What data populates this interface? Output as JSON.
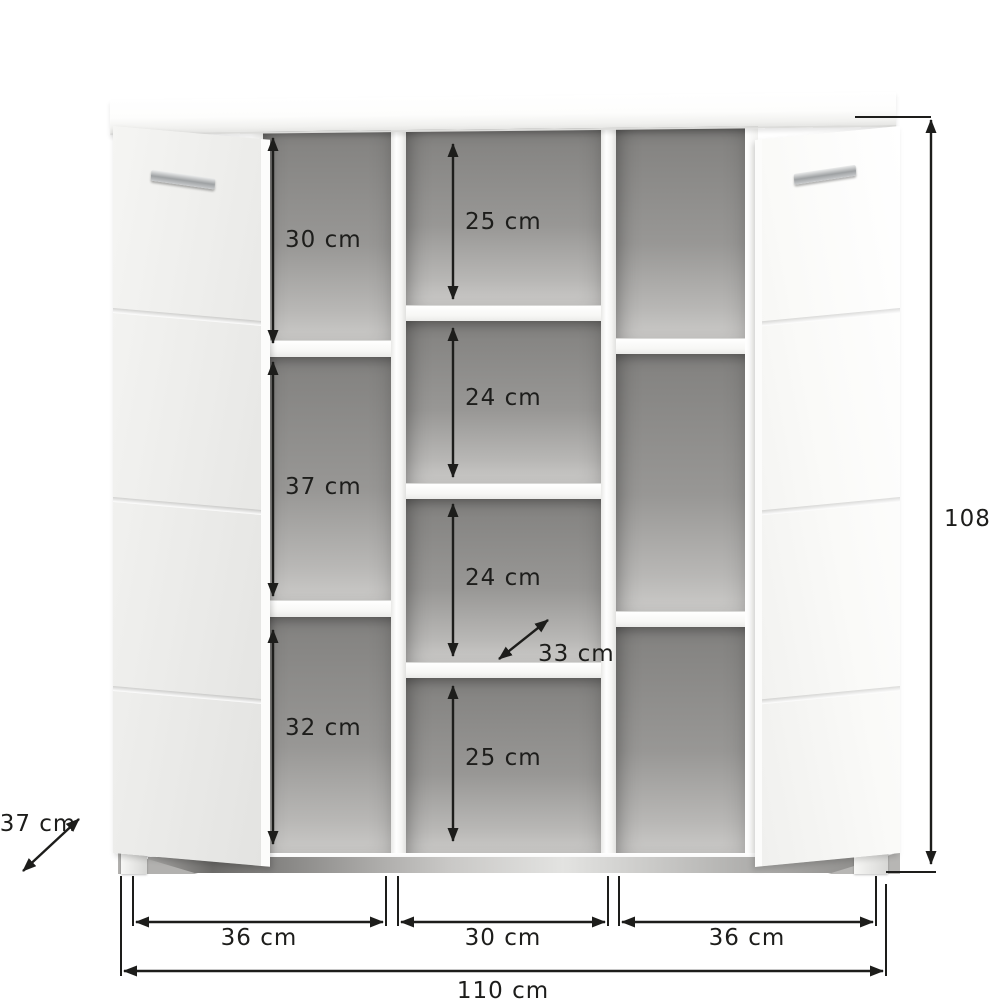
{
  "diagram": {
    "type": "furniture-dimension-diagram",
    "subject": "shoe cabinet with two open doors and open shelf compartments",
    "colors": {
      "background": "#ffffff",
      "dimension_ink": "#1d1d1b",
      "cabinet_white": "#fbfbfa",
      "interior_gray": "#989795",
      "door_gray": "#ededeb",
      "handle_silver": "#c8cacc"
    },
    "dims": {
      "left1": "30 cm",
      "left2": "37 cm",
      "left3": "32 cm",
      "mid1": "25 cm",
      "mid2": "24 cm",
      "mid3": "24 cm",
      "mid4": "25 cm",
      "shelf_depth": "33 cm",
      "depth": "37 cm",
      "height": "108 c",
      "bottom_left": "36 cm",
      "bottom_middle": "30 cm",
      "bottom_right": "36 cm",
      "total_width": "110 cm"
    }
  }
}
